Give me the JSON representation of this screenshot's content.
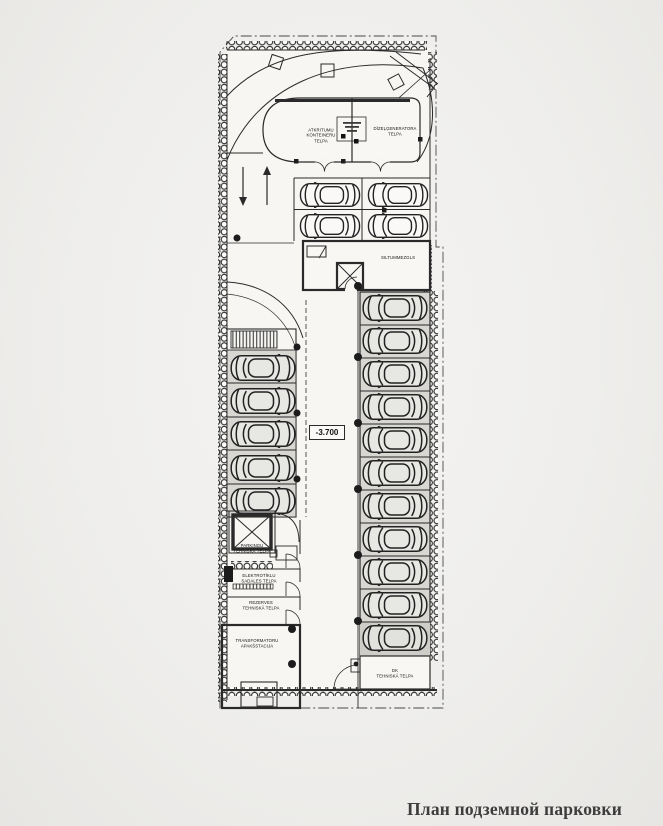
{
  "page": {
    "caption": "План подземной парковки"
  },
  "plan": {
    "level_mark": "-3.700",
    "labels": {
      "waste_room": "ATKRITUMU\nKONTEINERU\nTELPA",
      "diesel_room": "DĪZEĻĢENERATORA\nTELPA",
      "heat_unit": "SILTUMMEZGLS",
      "parking_tech": "PARKINGU\nTEHNISKĀ TELPA",
      "electrical": "ELEKTROTĪKLU\nSADALES TELPA",
      "reserve": "REZERVES\nTEHNISKĀ TELPA",
      "transformer": "TRANSFORMATORU\nAPAKŠSTACIJA",
      "tech_br": "DK\nTEHNISKĀ TELPA"
    },
    "colors": {
      "line": "#2a2a2a",
      "stall_fill": "#d8d7d2",
      "paper": "#f7f6f3",
      "caption_text": "#3d3d3d"
    }
  }
}
